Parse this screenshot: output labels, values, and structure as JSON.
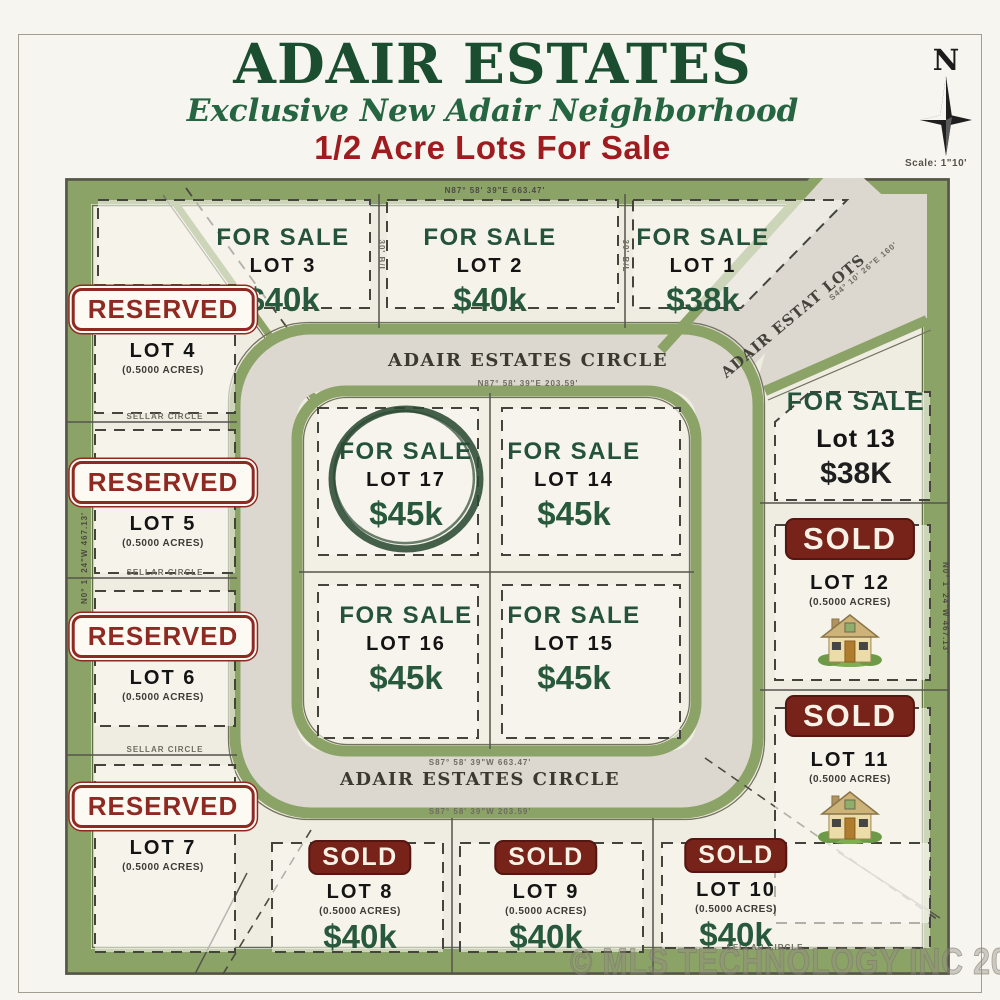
{
  "header": {
    "title": "ADAIR ESTATES",
    "subtitle": "Exclusive New Adair Neighborhood",
    "tagline": "1/2 Acre Lots For Sale"
  },
  "compass": {
    "north": "N",
    "scale": "Scale: 1\"10'"
  },
  "streets": {
    "circle_top": "ADAIR ESTATES CIRCLE",
    "circle_bottom": "ADAIR ESTATES CIRCLE",
    "diagonal": "ADAIR ESTAT LOTS"
  },
  "highlight": {
    "type": "hand-drawn-circle",
    "lot": "LOT 17"
  },
  "lots": [
    {
      "label": "LOT 1",
      "status": "FOR SALE",
      "price": "$38k"
    },
    {
      "label": "LOT 2",
      "status": "FOR SALE",
      "price": "$40k"
    },
    {
      "label": "LOT 3",
      "status": "FOR SALE",
      "price": "$40k"
    },
    {
      "label": "LOT 4",
      "status": "RESERVED",
      "acreage": "(0.5000 ACRES)"
    },
    {
      "label": "LOT 5",
      "status": "RESERVED",
      "acreage": "(0.5000 ACRES)"
    },
    {
      "label": "LOT 6",
      "status": "RESERVED",
      "acreage": "(0.5000 ACRES)"
    },
    {
      "label": "LOT 7",
      "status": "RESERVED",
      "acreage": "(0.5000 ACRES)"
    },
    {
      "label": "LOT 8",
      "status": "SOLD",
      "price": "$40k",
      "acreage": "(0.5000 ACRES)"
    },
    {
      "label": "LOT 9",
      "status": "SOLD",
      "price": "$40k",
      "acreage": "(0.5000 ACRES)"
    },
    {
      "label": "LOT 10",
      "status": "SOLD",
      "price": "$40k",
      "acreage": "(0.5000 ACRES)"
    },
    {
      "label": "LOT 11",
      "status": "SOLD",
      "acreage": "(0.5000 ACRES)"
    },
    {
      "label": "LOT 12",
      "status": "SOLD",
      "acreage": "(0.5000 ACRES)"
    },
    {
      "label": "Lot 13",
      "status": "FOR SALE",
      "price": "$38K"
    },
    {
      "label": "LOT 14",
      "status": "FOR SALE",
      "price": "$45k"
    },
    {
      "label": "LOT 15",
      "status": "FOR SALE",
      "price": "$45k"
    },
    {
      "label": "LOT 16",
      "status": "FOR SALE",
      "price": "$45k"
    },
    {
      "label": "LOT 17",
      "status": "FOR SALE",
      "price": "$45k"
    }
  ],
  "survey_texts": [
    "N87° 58' 39\"E  663.47'",
    "N87° 58' 39\"E  203.59'",
    "S87° 58' 39\"W  203.59'",
    "S87° 58' 39\"W  663.47'",
    "S44° 10' 26\"E  160'",
    "N0° 1' 24\"W  467.13'",
    "N0° 1' 24\"W  467.13'",
    "SELLAR CIRCLE",
    "SELLAR CIRCLE",
    "SELLAR CIRCLE",
    "SELLAR CIRCLE",
    "30' B/L",
    "30' B/L"
  ],
  "watermark": "© MLS TECHNOLOGY INC 2025",
  "colors": {
    "title_green": "#1b4d30",
    "text_green": "#24523a",
    "price_green": "#28593c",
    "heading_red": "#9e1b1f",
    "reserved_red": "#8f2a22",
    "sold_bg": "#77231a",
    "road_green": "#8ca368",
    "road_gray": "#dcd8d0",
    "paper": "#efede2"
  }
}
